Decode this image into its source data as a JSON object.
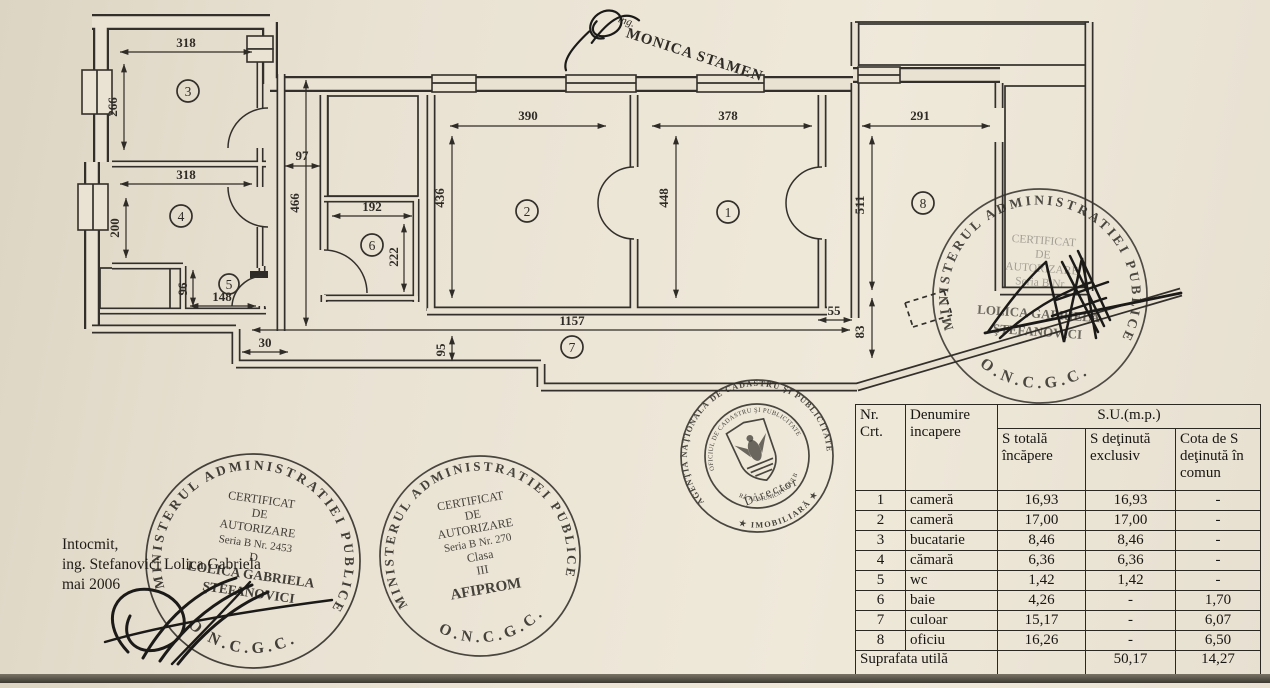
{
  "page": {
    "paper_color": "#e9e2d3",
    "ink_color": "#33302b",
    "stamp_ink": "#26231f"
  },
  "plan": {
    "room_labels": {
      "r1": "1",
      "r2": "2",
      "r3": "3",
      "r4": "4",
      "r5": "5",
      "r6": "6",
      "r7": "7",
      "r8": "8"
    },
    "dims": {
      "r3w": "318",
      "r3h": "266",
      "r4w": "318",
      "r4h": "200",
      "r5w": "148",
      "r5h": "96",
      "r6w": "192",
      "r6h": "222",
      "r2w": "390",
      "r2h": "436",
      "r1w": "378",
      "r1h": "448",
      "r8w": "291",
      "r8h": "511",
      "hall_len": "1157",
      "hall_w": "95",
      "gap": "97",
      "vest": "466",
      "step": "30",
      "d55": "55",
      "d83": "83"
    }
  },
  "stamps": {
    "monica": {
      "prefix": "ing.",
      "name": "MONICA STAMEN"
    },
    "ministry_ring": "MINISTERUL  ADMINISTRATIEI  PUBLICE",
    "oncgc": "O.N.C.G.C.",
    "left": {
      "l1": "CERTIFICAT",
      "l2": "DE",
      "l3": "AUTORIZARE",
      "l4": "Seria B  Nr. 2453",
      "l5": "D",
      "l6": "LOLICA GABRIELA",
      "l7": "ŞTEFANOVICI"
    },
    "center": {
      "l1": "CERTIFICAT",
      "l2": "DE",
      "l3": "AUTORIZARE",
      "l4": "Seria B  Nr. 270",
      "l5": "Clasa",
      "l6": "III",
      "l7": "AFIPROM"
    },
    "right": {
      "l1": "CERTIFICAT",
      "l2": "DE",
      "l3": "AUTORIZARE",
      "l4": "Seria B  Nr.",
      "l5": "LOLICA GABRIELA",
      "l6": "ŞTEFANOVICI"
    },
    "seal": {
      "ring_top": "AGENŢIA NAŢIONALĂ DE CADASTRU ŞI PUBLICITATE",
      "ring_bottom": "★ IMOBILIARĂ ★",
      "inner_top": "OFICIUL DE CADASTRU ŞI PUBLICITATE",
      "inner_bottom": "IMOBILIARĂ AL MUNICIPIULUI BUCUREŞTI",
      "director": "Director"
    }
  },
  "notes": {
    "l1": "Intocmit,",
    "l2": "ing. Stefanovici Lolica Gabriela",
    "l3": "mai 2006"
  },
  "table": {
    "headers": {
      "nr": "Nr. Crt.",
      "name": "Denumire incapere",
      "su": "S.U.(m.p.)",
      "total": "S totală încăpere",
      "excl": "S deţinută exclusiv",
      "cota": "Cota de S deţinută în comun"
    },
    "rows": [
      {
        "nr": "1",
        "name": "cameră",
        "total": "16,93",
        "excl": "16,93",
        "cota": "-"
      },
      {
        "nr": "2",
        "name": "cameră",
        "total": "17,00",
        "excl": "17,00",
        "cota": "-"
      },
      {
        "nr": "3",
        "name": "bucatarie",
        "total": "8,46",
        "excl": "8,46",
        "cota": "-"
      },
      {
        "nr": "4",
        "name": "cămară",
        "total": "6,36",
        "excl": "6,36",
        "cota": "-"
      },
      {
        "nr": "5",
        "name": "wc",
        "total": "1,42",
        "excl": "1,42",
        "cota": "-"
      },
      {
        "nr": "6",
        "name": "baie",
        "total": "4,26",
        "excl": "-",
        "cota": "1,70"
      },
      {
        "nr": "7",
        "name": "culoar",
        "total": "15,17",
        "excl": "-",
        "cota": "6,07"
      },
      {
        "nr": "8",
        "name": "oficiu",
        "total": "16,26",
        "excl": "-",
        "cota": "6,50"
      }
    ],
    "footer": {
      "label": "Suprafata utilă",
      "total": "",
      "excl": "50,17",
      "cota": "14,27"
    }
  }
}
